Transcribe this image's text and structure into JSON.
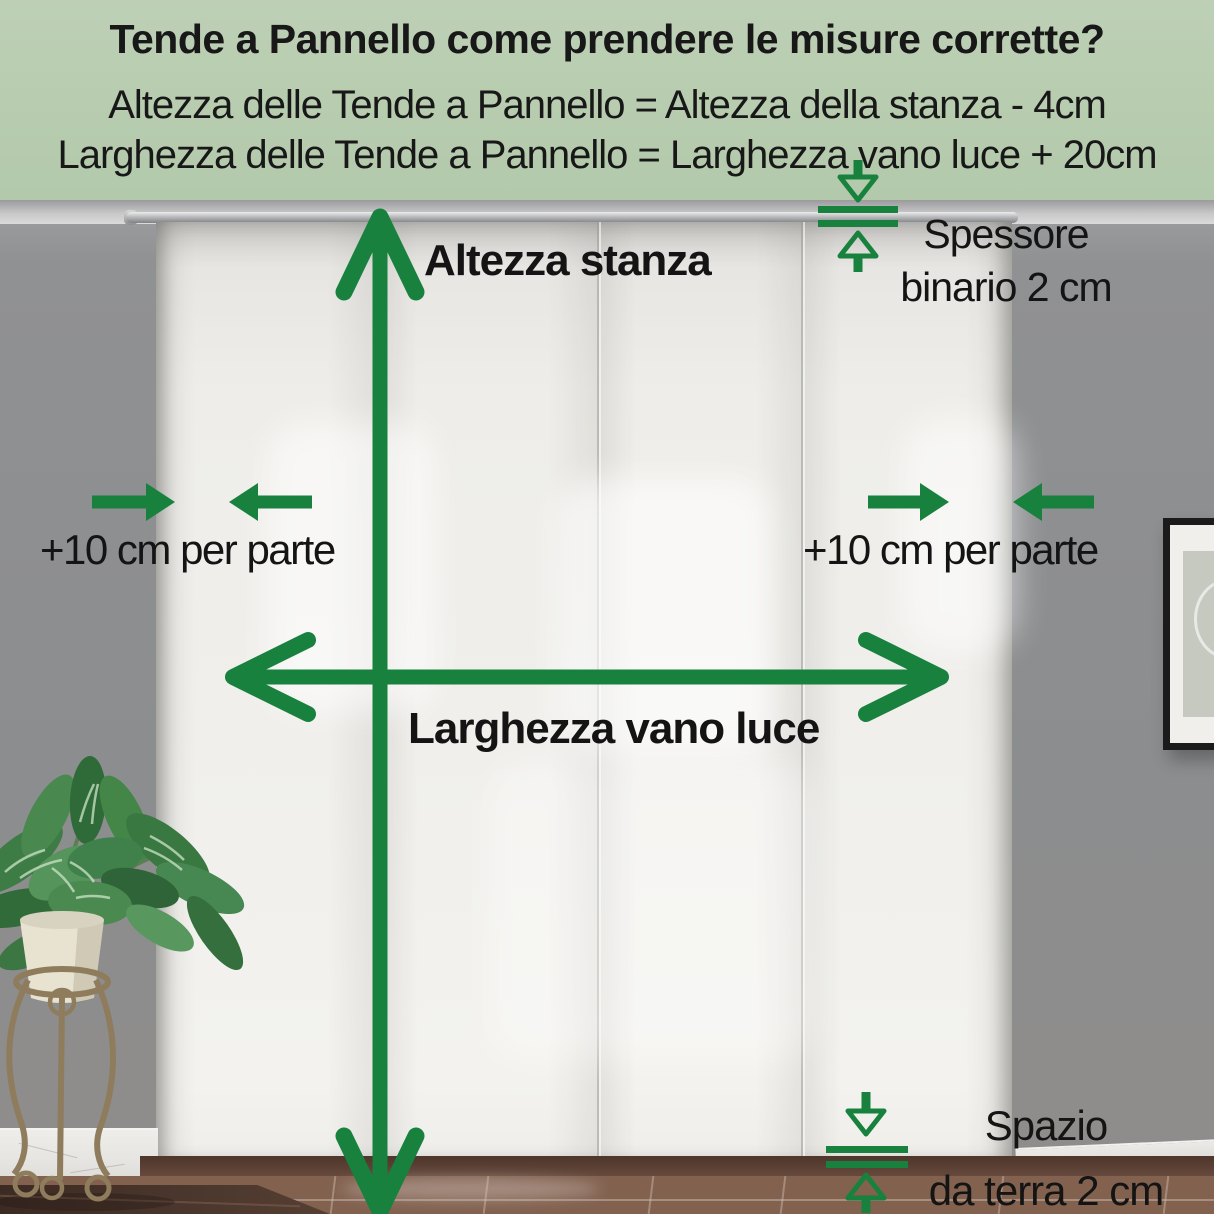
{
  "header": {
    "title": "Tende a Pannello come prendere le misure corrette?",
    "formula_height": "Altezza delle Tende a Pannello = Altezza della stanza - 4cm",
    "formula_width": "Larghezza delle Tende a Pannello = Larghezza vano luce + 20cm"
  },
  "annotations": {
    "room_height": {
      "label": "Altezza stanza"
    },
    "opening_width": {
      "label": "Larghezza vano luce"
    },
    "left_margin": {
      "label": "+10 cm per parte"
    },
    "right_margin": {
      "label": "+10 cm per parte"
    },
    "track": {
      "line1": "Spessore",
      "line2": "binario 2 cm"
    },
    "floor_gap": {
      "line1": "Spazio",
      "line2": "da terra 2 cm"
    }
  },
  "colors": {
    "accent_green": "#17813d",
    "header_background": "#b7ccae",
    "label_text": "#141414",
    "wall_gray": "#8e8f91",
    "curtain_white": "#f0efec",
    "floor_brown": "#82614f"
  }
}
